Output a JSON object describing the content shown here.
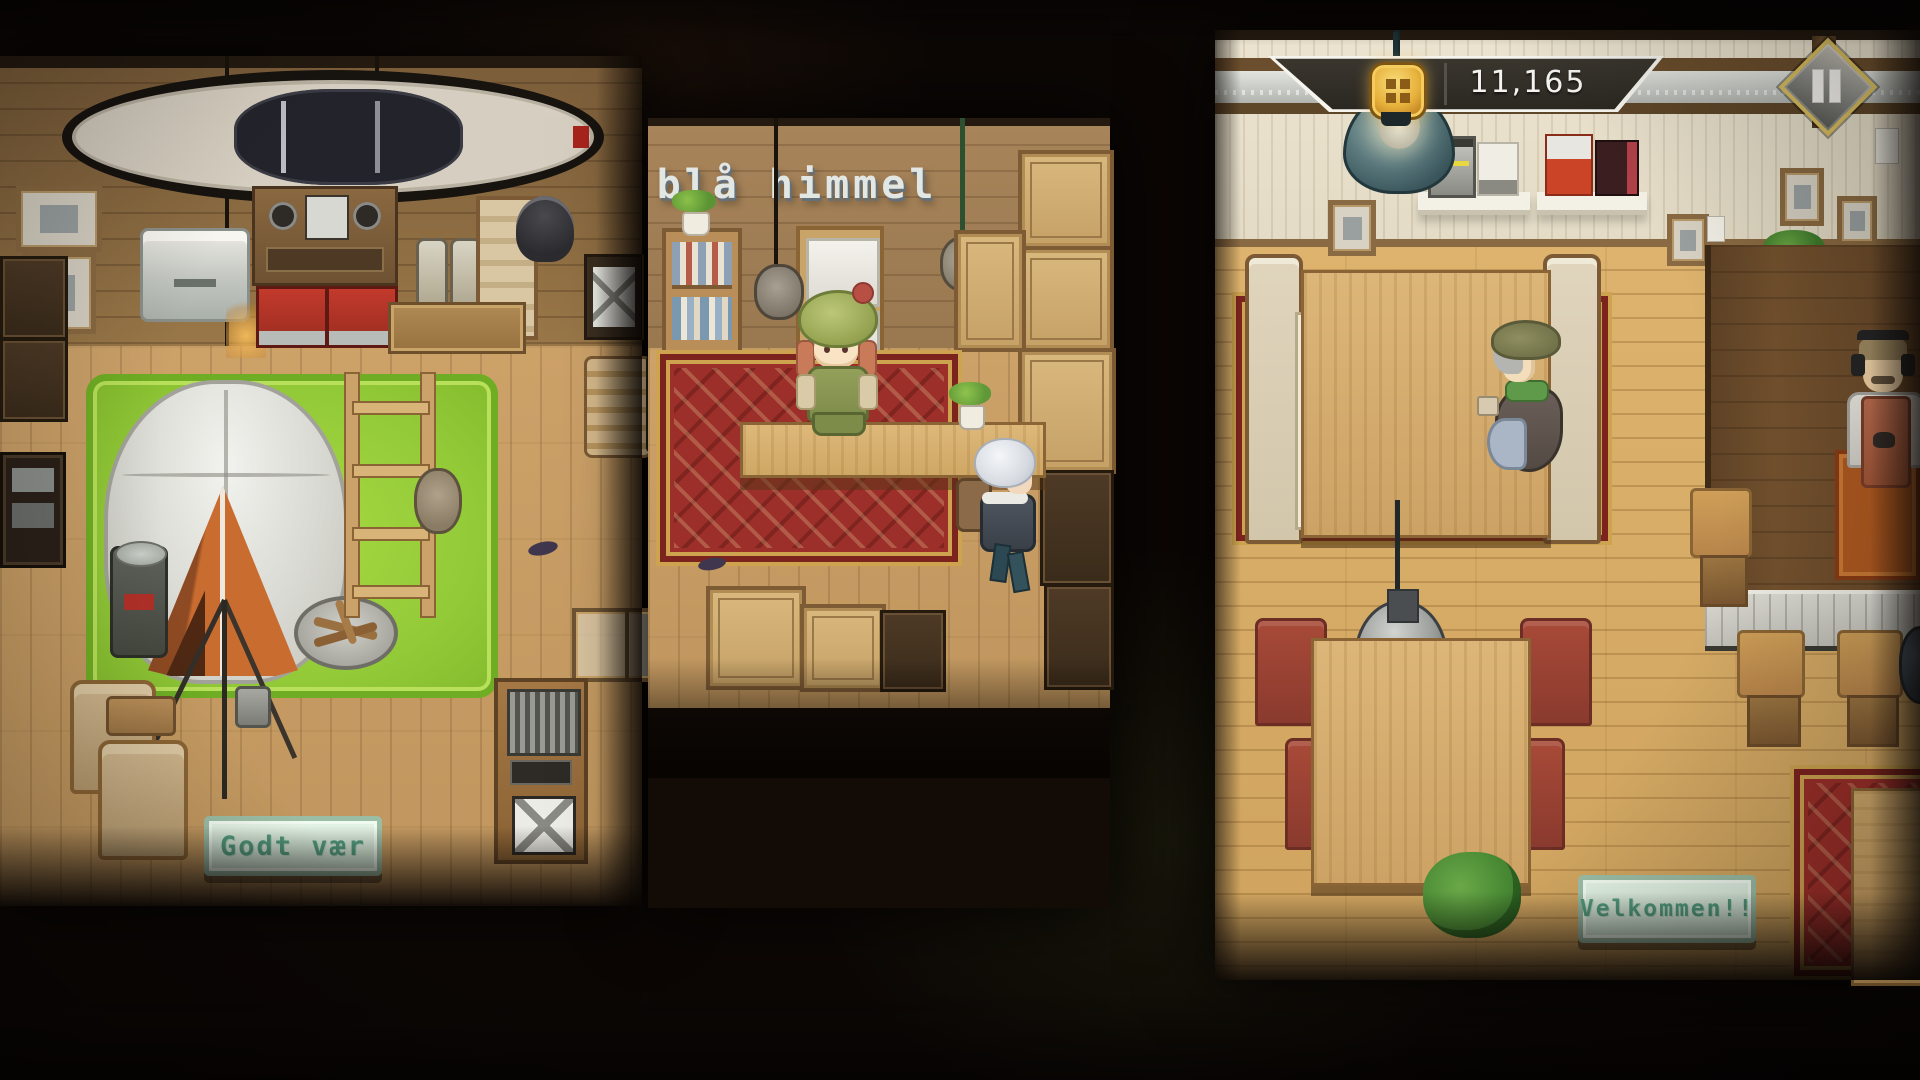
{
  "hud": {
    "currency": {
      "icon": "coin-icon",
      "value": "11,165"
    },
    "pause": {
      "icon": "pause-icon"
    }
  },
  "signs": {
    "mid_shop_name": "blå himmel",
    "left_shop_plaque": "Godt vær",
    "cafe_plaque": "Velkommen!!"
  },
  "icons": {
    "coin-icon": "gold rounded-square medallion with dark quatrefoil",
    "pause-icon": "two white vertical bars in gold-edged grey diamond"
  },
  "colors": {
    "hud_bar_fill": "#322e28",
    "hud_bar_outline": "#f6f4ee",
    "coin_gold": "#e7b23c",
    "pause_gold": "#dcc05f",
    "sign_bg": "#d9ecdd",
    "sign_text": "#55a083",
    "grass_mat": "#93ca38",
    "tent_orange": "#c0662c",
    "carpet_red": "#9c2f29",
    "cafe_wall": "#e9e1cd",
    "cafe_floor_wood": "#ddb36d",
    "left_shop_wood": "#cda269",
    "pendant_lamp_teal": "#46646a",
    "pendant_lamp_grey": "#9a9d9a"
  }
}
